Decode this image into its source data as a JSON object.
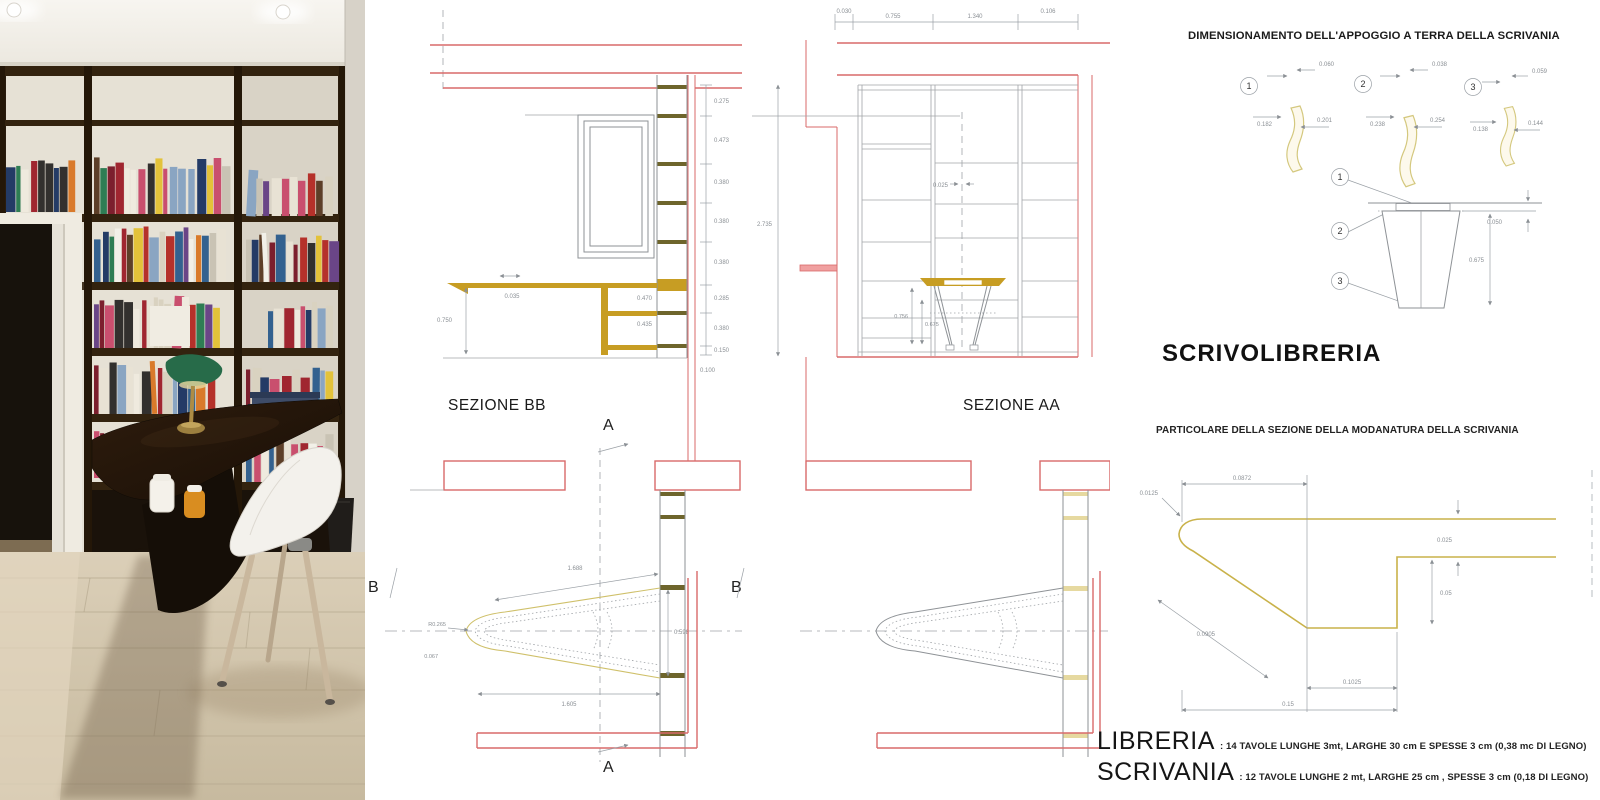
{
  "photo": {
    "book_palette": [
      "#b5312a",
      "#d97a2b",
      "#e3c23a",
      "#33618f",
      "#6a4587",
      "#2e7d54",
      "#c9c3b4",
      "#efeade",
      "#7c1f2d",
      "#243b66",
      "#c94f6e",
      "#5d3f28",
      "#e8e2d4",
      "#a02630",
      "#f2f0e8",
      "#32302e",
      "#8aa5c2",
      "#d9d2c0"
    ],
    "book_rows": [
      {
        "x": 6,
        "y": 156,
        "w": 72,
        "h": 56,
        "n": 7
      },
      {
        "x": 94,
        "y": 154,
        "w": 134,
        "h": 60,
        "n": 17
      },
      {
        "x": 246,
        "y": 168,
        "w": 90,
        "h": 48,
        "n": 11
      },
      {
        "x": 94,
        "y": 224,
        "w": 134,
        "h": 58,
        "n": 16
      },
      {
        "x": 246,
        "y": 232,
        "w": 90,
        "h": 50,
        "n": 10
      },
      {
        "x": 94,
        "y": 294,
        "w": 126,
        "h": 54,
        "n": 13
      },
      {
        "x": 268,
        "y": 300,
        "w": 68,
        "h": 48,
        "n": 7
      },
      {
        "x": 94,
        "y": 360,
        "w": 118,
        "h": 54,
        "n": 12
      },
      {
        "x": 246,
        "y": 366,
        "w": 90,
        "h": 48,
        "n": 9
      },
      {
        "x": 246,
        "y": 432,
        "w": 88,
        "h": 50,
        "n": 9
      },
      {
        "x": 94,
        "y": 428,
        "w": 56,
        "h": 50,
        "n": 6
      }
    ]
  },
  "cad": {
    "bb": {
      "label": "SEZIONE BB",
      "marker_top": "A",
      "marker_bottom": "A",
      "marker_left": "B",
      "marker_right": "B",
      "desk_depth": "0.750",
      "desk_thickness": "0.035",
      "inner_dims": [
        "0.470",
        "0.435"
      ],
      "right_dims": [
        "0.275",
        "0.473",
        "0.380",
        "0.380",
        "0.380",
        "0.285",
        "0.380",
        "0.150"
      ],
      "bottom_dim": "0.100",
      "plan": {
        "diagonal": "1.688",
        "length": "1.605",
        "radius": "R0.265",
        "tip": "0.067",
        "width": "0.598"
      }
    },
    "aa": {
      "label": "SEZIONE AA",
      "top_dims": [
        "0.030",
        "0.755",
        "1.340",
        "0.106"
      ],
      "total_height": "2.735",
      "shelf_gap": "0.025",
      "leg_dims": [
        "0.756",
        "0.675"
      ]
    }
  },
  "right_panel": {
    "top_title": "DIMENSIONAMENTO DELL'APPOGGIO A TERRA DELLA SCRIVANIA",
    "appoggio_details": [
      {
        "num": "1",
        "dim_top": "0.060",
        "dim_left": "0.182",
        "dim_right": "0.201"
      },
      {
        "num": "2",
        "dim_top": "0.038",
        "dim_left": "0.238",
        "dim_right": "0.254"
      },
      {
        "num": "3",
        "dim_top": "0.059",
        "dim_left": "0.138",
        "dim_right": "0.144"
      }
    ],
    "leg_detail": {
      "callout_1": "1",
      "callout_2": "2",
      "callout_3": "3",
      "dim_top": "0.050",
      "dim_height": "0.675"
    },
    "main_title": "SCRIVOLIBRERIA",
    "profile_title": "PARTICOLARE DELLA SEZIONE DELLA MODANATURA DELLA SCRIVANIA",
    "profile_dims": {
      "nose": "0.0125",
      "top": "0.0872",
      "slope": "0.0905",
      "step": "0.1025",
      "base": "0.15",
      "thickness": "0.025",
      "drop": "0.05"
    },
    "materials": [
      {
        "name": "LIBRERIA",
        "spec": ": 14 TAVOLE LUNGHE 3mt, LARGHE 30 cm E SPESSE 3 cm (0,38 mc DI LEGNO)"
      },
      {
        "name": "SCRIVANIA",
        "spec": ": 12 TAVOLE LUNGHE 2 mt, LARGHE 25 cm , SPESSE 3 cm (0,18 DI LEGNO)"
      }
    ]
  },
  "colors": {
    "red": "#d96a6a",
    "gold": "#c79d23",
    "olive": "#6e652c",
    "pale": "#dbcf8a",
    "line": "#9aa0a6"
  }
}
